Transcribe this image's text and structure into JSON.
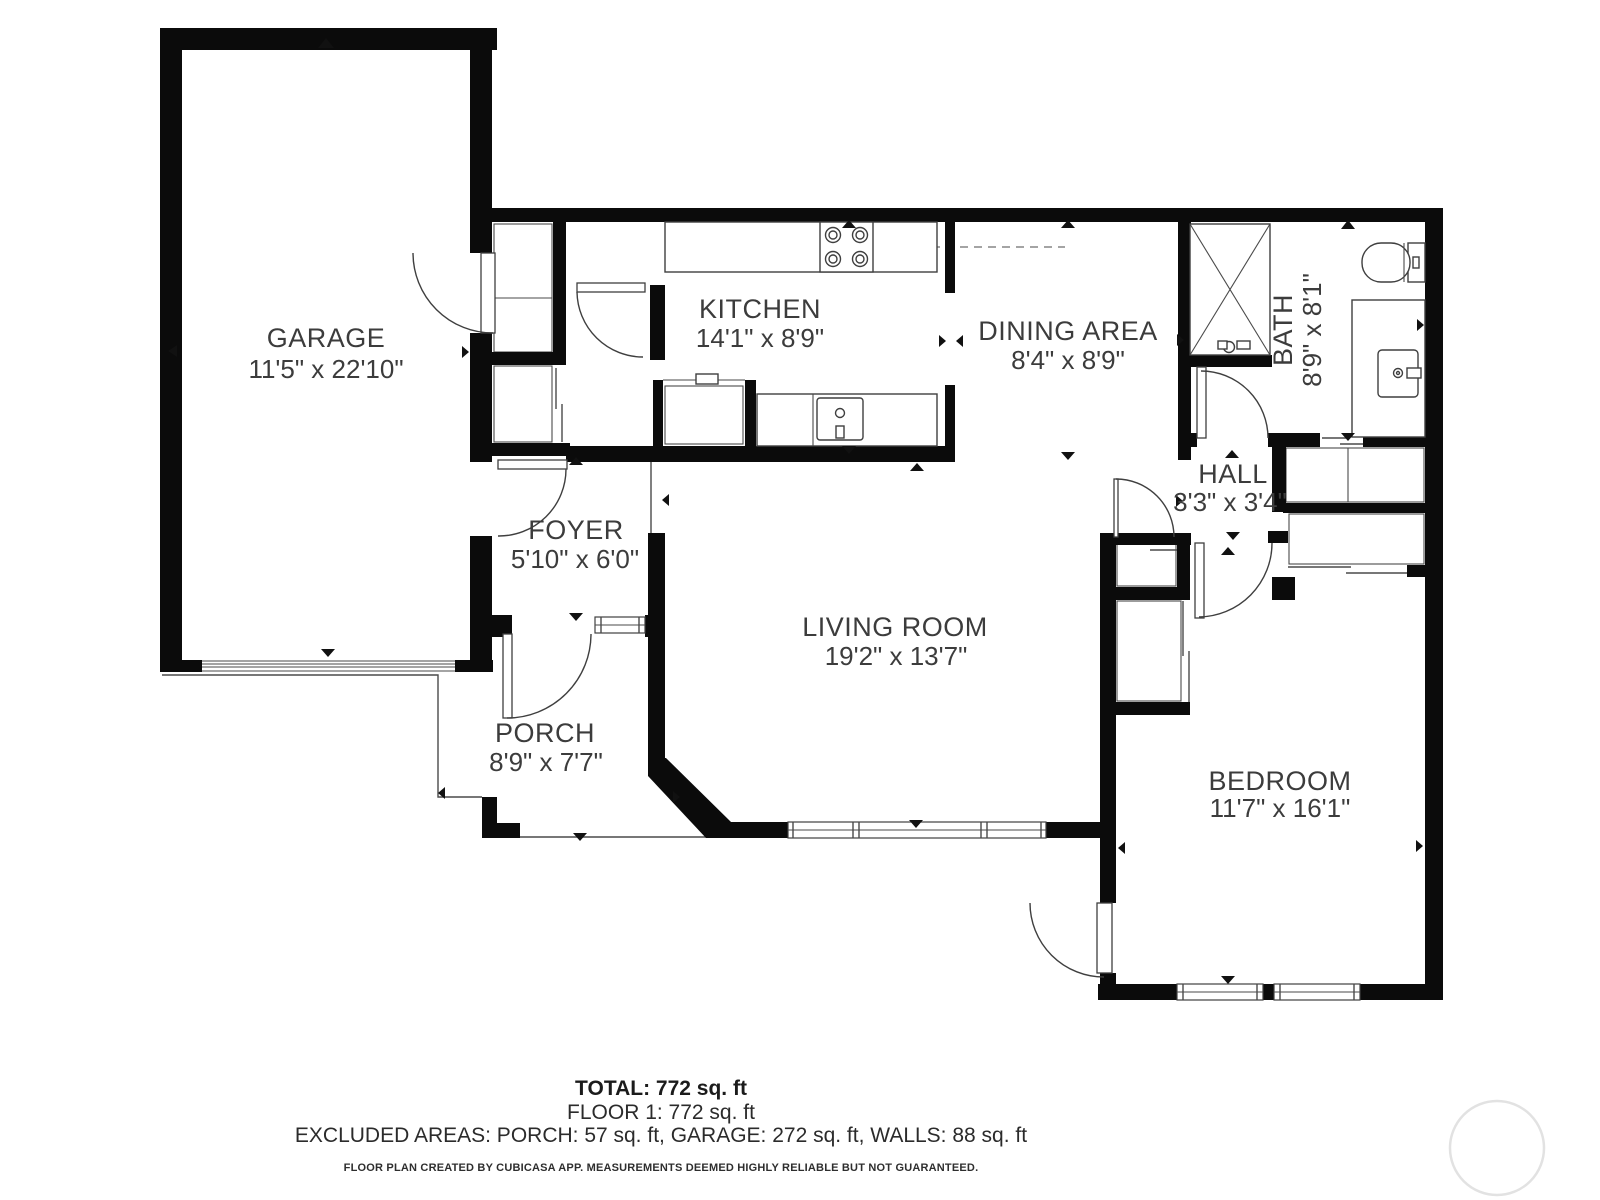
{
  "plan": {
    "rooms": [
      {
        "id": "garage",
        "name": "GARAGE",
        "dims": "11'5\" x 22'10\""
      },
      {
        "id": "kitchen",
        "name": "KITCHEN",
        "dims": "14'1\" x 8'9\""
      },
      {
        "id": "dining",
        "name": "DINING AREA",
        "dims": "8'4\" x 8'9\""
      },
      {
        "id": "bath",
        "name": "BATH",
        "dims": "8'9\" x 8'1\""
      },
      {
        "id": "hall",
        "name": "HALL",
        "dims": "3'3\" x 3'4\""
      },
      {
        "id": "foyer",
        "name": "FOYER",
        "dims": "5'10\" x 6'0\""
      },
      {
        "id": "living",
        "name": "LIVING ROOM",
        "dims": "19'2\" x 13'7\""
      },
      {
        "id": "porch",
        "name": "PORCH",
        "dims": "8'9\" x 7'7\""
      },
      {
        "id": "bedroom",
        "name": "BEDROOM",
        "dims": "11'7\" x 16'1\""
      }
    ],
    "summary": {
      "total": "TOTAL: 772 sq. ft",
      "floor": "FLOOR 1: 772 sq. ft",
      "excluded": "EXCLUDED AREAS: PORCH: 57 sq. ft, GARAGE: 272 sq. ft, WALLS: 88 sq. ft",
      "disclaimer": "FLOOR PLAN CREATED BY CUBICASA APP. MEASUREMENTS DEEMED HIGHLY RELIABLE BUT NOT GUARANTEED."
    },
    "colors": {
      "wall": "#0b0b0b",
      "text": "#3c3c3c",
      "accent": "#111111",
      "watermark": "#e2e2e2"
    }
  }
}
